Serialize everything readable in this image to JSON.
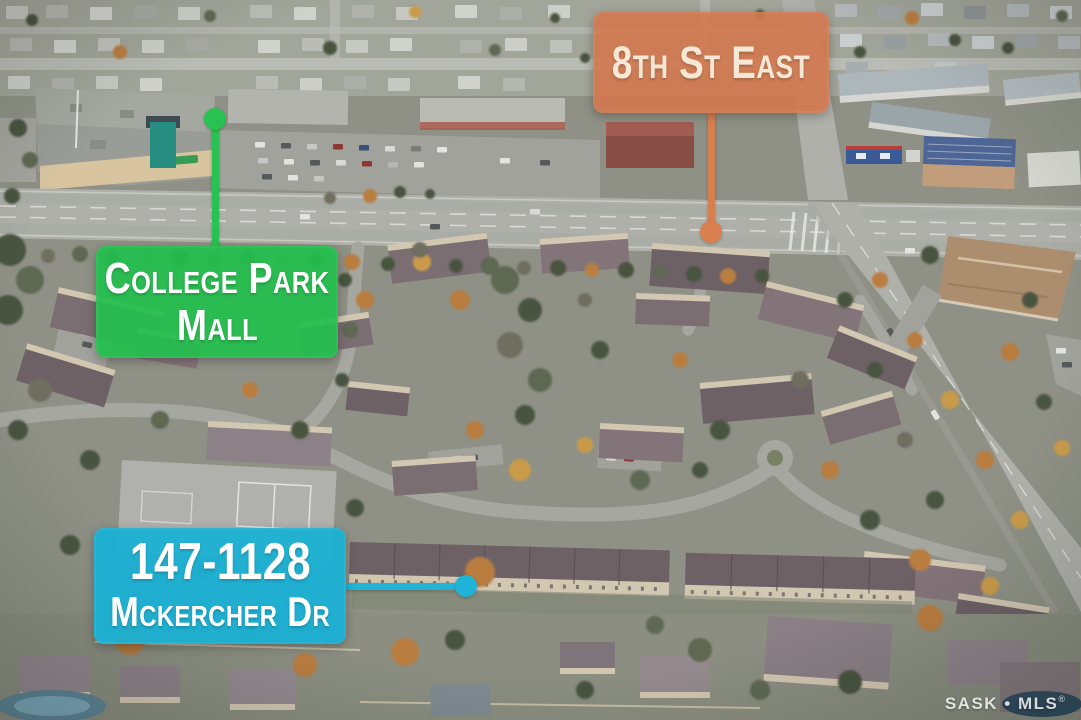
{
  "callouts": {
    "street": {
      "label": "8th St East",
      "color": "#d1784e"
    },
    "mall": {
      "line1": "College Park",
      "line2": "Mall",
      "color": "#22be4d"
    },
    "property": {
      "line1": "147-1128",
      "line2": "Mckercher Dr",
      "color": "#19b0d5"
    }
  },
  "watermark": {
    "brand": "SASK • MLS",
    "registered": "®"
  }
}
